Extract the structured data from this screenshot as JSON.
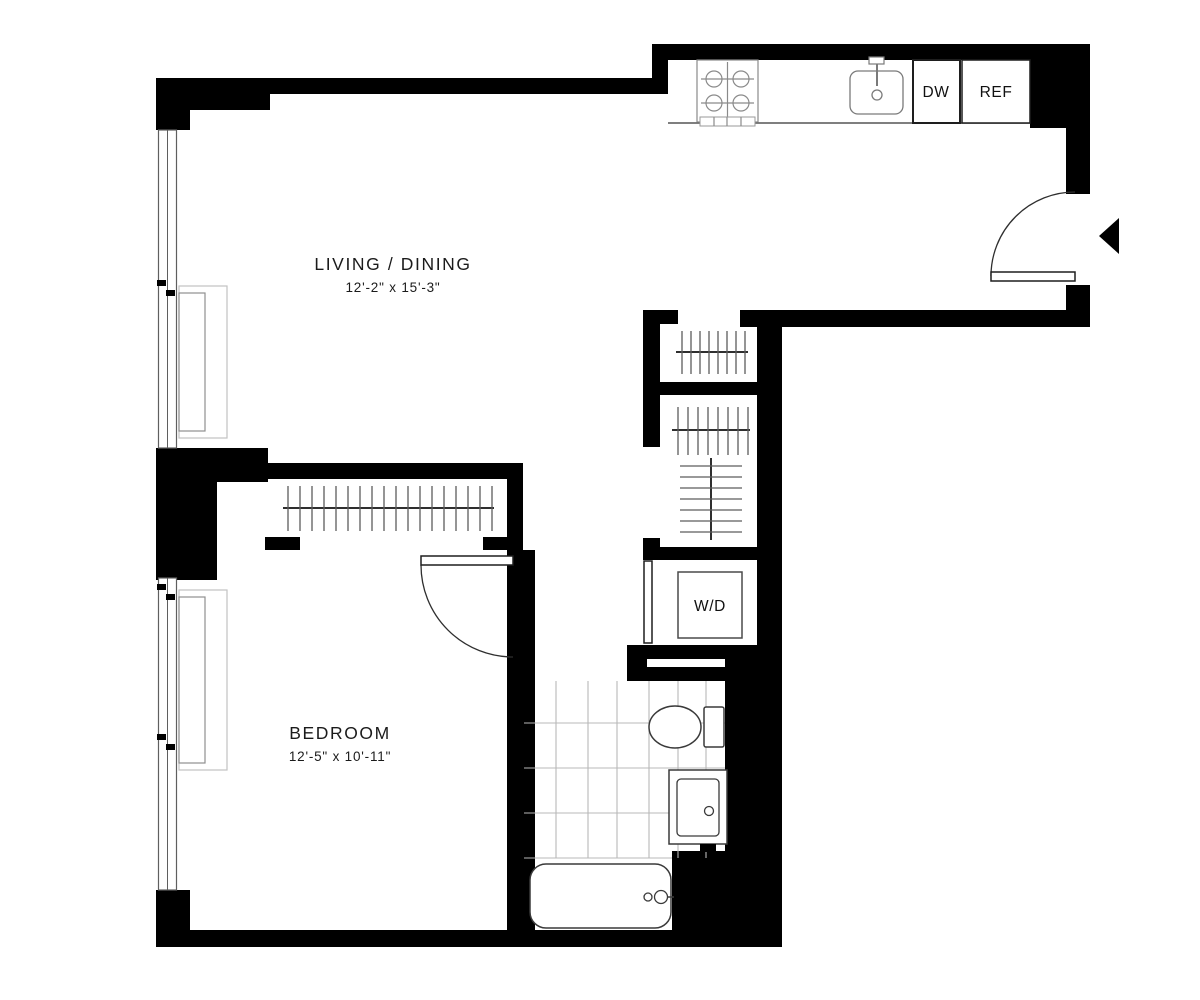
{
  "floor_plan": {
    "type": "apartment-floor-plan",
    "rooms": [
      {
        "id": "living_dining",
        "label": "LIVING / DINING",
        "dimensions": "12'-2\" x 15'-3\""
      },
      {
        "id": "bedroom",
        "label": "BEDROOM",
        "dimensions": "12'-5\" x 10'-11\""
      }
    ],
    "appliances": [
      {
        "id": "dishwasher",
        "label": "DW"
      },
      {
        "id": "refrigerator",
        "label": "REF"
      },
      {
        "id": "washer_dryer",
        "label": "W/D"
      }
    ],
    "fixtures": [
      "stove-icon",
      "kitchen-sink-icon",
      "toilet-icon",
      "vanity-sink-icon",
      "bathtub-icon",
      "radiator-icon",
      "window-icon",
      "closet-rod-icon",
      "door-swing-icon",
      "entry-arrow-icon",
      "tile-grid-icon",
      "washer-dryer-icon"
    ],
    "colors": {
      "wall": "#000000",
      "fixture_outline": "#3a3a3a",
      "light_outline": "#8a8a8a",
      "tile_line": "#b8b8b8",
      "text": "#1b1b1b",
      "background": "#ffffff"
    }
  }
}
